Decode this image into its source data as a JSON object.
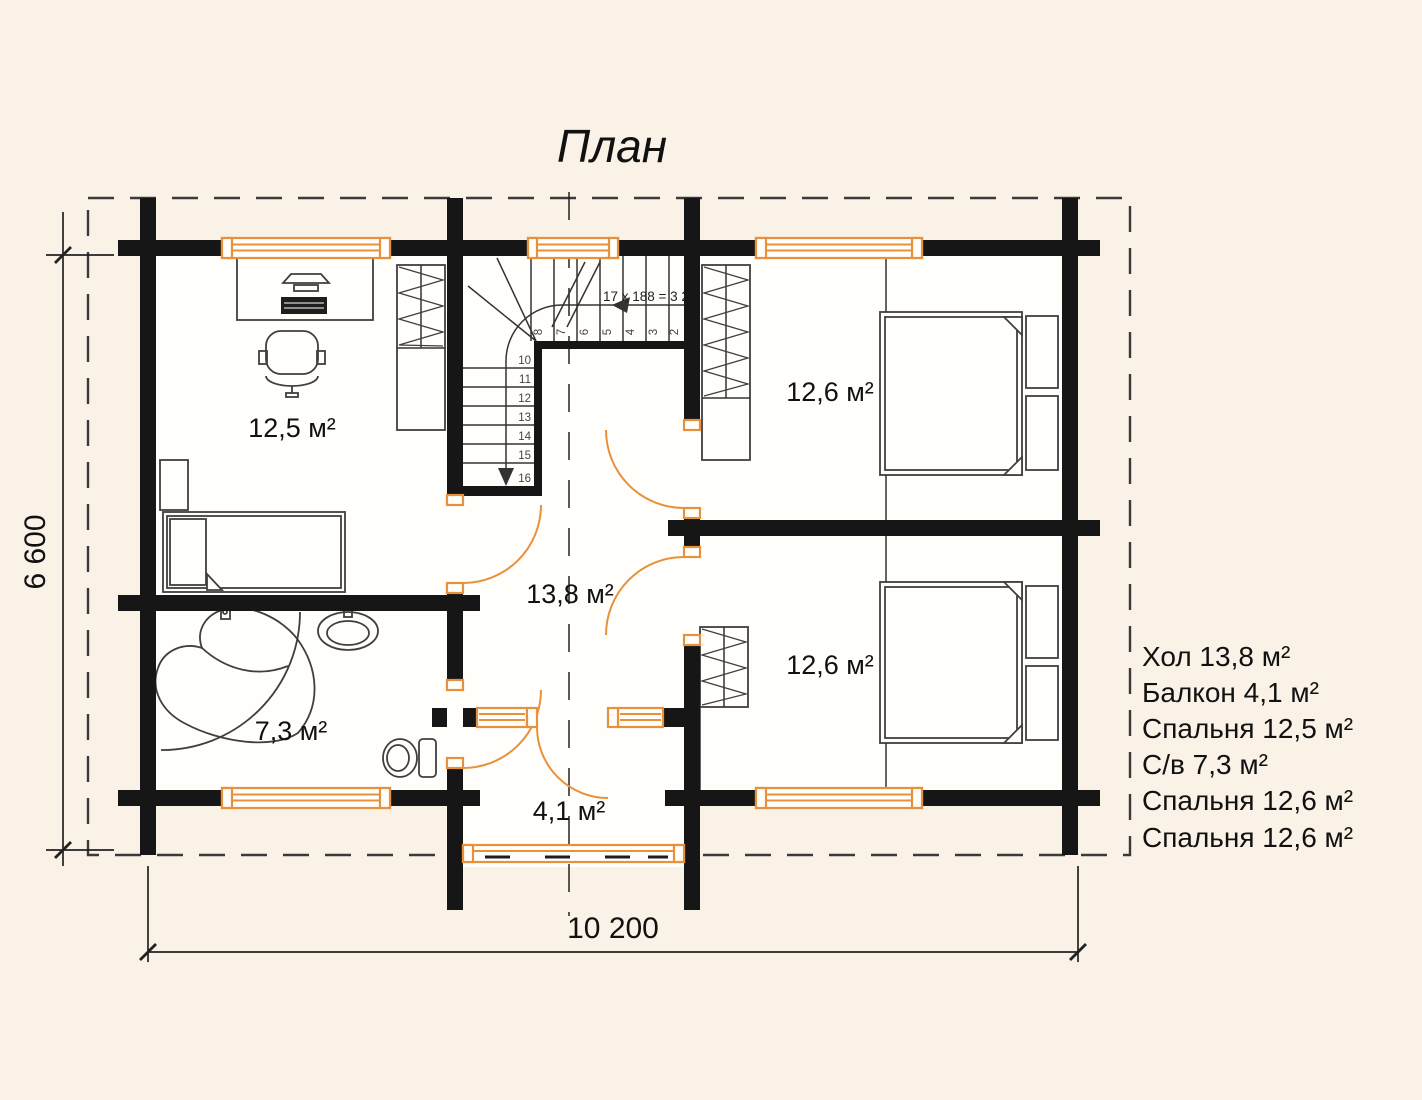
{
  "title": "План",
  "colors": {
    "accent": "#e8913c",
    "wall": "#161616",
    "paper": "#faf2e7"
  },
  "rooms": {
    "bedroom_left": "12,5 м²",
    "hall": "13,8 м²",
    "bathroom": "7,3 м²",
    "balcony": "4,1 м²",
    "bedroom_top_right": "12,6 м²",
    "bedroom_bottom_right": "12,6 м²"
  },
  "stairs": {
    "annotation": "17 x 188 = 3 2",
    "upper_steps": [
      "8",
      "7",
      "6",
      "5",
      "4",
      "3",
      "2"
    ],
    "lower_steps": [
      "10",
      "11",
      "12",
      "13",
      "14",
      "15",
      "16"
    ]
  },
  "dimensions": {
    "horizontal": "10 200",
    "vertical": "6 600"
  },
  "legend": {
    "items": [
      "Хол 13,8 м²",
      "Балкон 4,1 м²",
      "Спальня 12,5 м²",
      "С/в 7,3 м²",
      "Спальня 12,6 м²",
      "Спальня 12,6 м²"
    ]
  }
}
